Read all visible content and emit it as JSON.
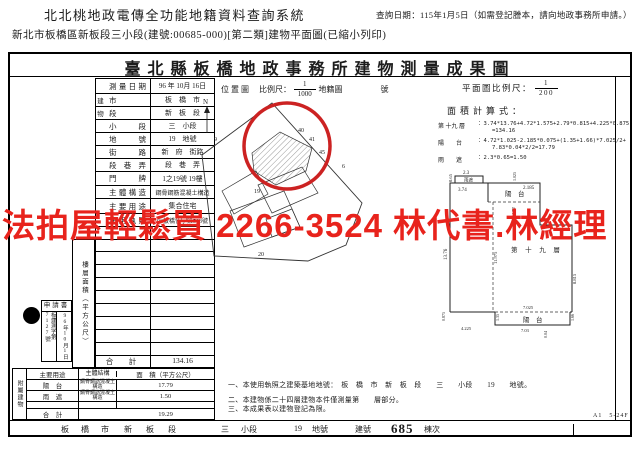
{
  "header": {
    "system_title": "北北桃地政電傳全功能地籍資料查詢系統",
    "query_date": "查詢日期：115年1月5日（如需登記謄本，請向地政事務所申請。）",
    "subtitle": "新北市板橋區新板段三小段(建號:00685-000)[第二類]建物平面圖(已縮小列印)"
  },
  "watermark": {
    "text": "法拍屋輕鬆買  2266-3524  林代書.林經理",
    "color": "#e8231c"
  },
  "doc": {
    "title": "臺北縣板橋地政事務所建物測量成果圖",
    "location_map_label": "位置圖",
    "scale_label": "比例尺：",
    "scale_num": "1",
    "scale_den": "1000",
    "cadastral_label": "地籍圖",
    "cadastral_no_label": "號",
    "plan_scale_label": "平面圖比例尺：",
    "plan_scale_num": "1",
    "plan_scale_den": "200",
    "north": "N",
    "fields": [
      {
        "g": "",
        "label": "測量日期",
        "value": "96 年 10月 16日"
      },
      {
        "g": "建",
        "label": "市",
        "value": "板　橋　市"
      },
      {
        "g": "物",
        "label": "段",
        "value": "新　板　段"
      },
      {
        "g": "",
        "label": "小段",
        "value": "三　小段"
      },
      {
        "g": "",
        "label": "地號",
        "value": "19　地號"
      },
      {
        "g": "",
        "label": "街路",
        "value": "新　府　街路"
      },
      {
        "g": "",
        "label": "段巷弄",
        "value": "段　巷　弄"
      },
      {
        "g": "",
        "label": "門牌",
        "value": "1之19號 19樓"
      },
      {
        "g": "",
        "label": "主體構造",
        "value": "鋼骨鋼筋混凝土構造"
      },
      {
        "g": "",
        "label": "主要用途",
        "value": "集合住宅"
      },
      {
        "g": "",
        "label": "使用執照",
        "value": "96板橋使字第503號"
      },
      {
        "g": "",
        "label": "",
        "value": ""
      }
    ],
    "floor_col_header": "樓層面積（平方公尺）",
    "floor_total_label": "合　計",
    "floor_total_value": "134.16",
    "application": {
      "title": "申請書",
      "doc_no": "板建測字第7127號",
      "date": "96年10月1日"
    },
    "annex": {
      "section_label": "附屬建物",
      "col_usage": "主要用途",
      "col_structure": "主體結構",
      "col_area": "面　積（平方公尺）",
      "rows": [
        {
          "usage": "陽　台",
          "structure": "鋼骨鋼筋混凝土構造",
          "area": "17.79"
        },
        {
          "usage": "雨　遮",
          "structure": "鋼骨鋼筋混凝土構造",
          "area": "1.50"
        }
      ],
      "total_label": "合　計",
      "total_value": "19.29"
    },
    "area_calc": {
      "title": "面積計算式：",
      "lines": [
        {
          "label": "第 十九 層",
          "formula": "：3.74*13.76+4.72*1.575+2.79*0.815+4.225*0.875",
          "formula2": "=134.16"
        },
        {
          "label": "陽　　台",
          "formula": "：4.72*1.025-2.185*0.075+(1.35+1.66)*7.025/2+",
          "formula2": "7.83*0.04*2/2=17.79"
        },
        {
          "label": "雨　　遮",
          "formula": "：2.3*0.65=1.50",
          "formula2": ""
        }
      ]
    },
    "map": {
      "p9": "9",
      "p40": "40",
      "p41": "41",
      "p45": "45",
      "p6": "6",
      "p19": "19",
      "p20": "20",
      "circle_color": "#cc2222"
    },
    "plan": {
      "room_label": "第 十 九 層",
      "balcony_top_label": "陽　台",
      "balcony_bottom_label": "陽　台",
      "canopy_label": "雨遮",
      "dims": {
        "d23": "2.3",
        "d065": "0.65",
        "d374": "3.74",
        "d2185": "2.185",
        "d1025": "1.025",
        "d472": "4.72",
        "d1376": "13.76",
        "d11975": "11.975",
        "d8815": "8.815",
        "d7025": "7.025",
        "d4225": "4.225",
        "d0875": "0.875",
        "d135": "1.35",
        "d703": "7.03",
        "d004": "0.04",
        "d166": "1.66"
      }
    },
    "notes": [
      "一、本使用執照之建築基地地號：　板　橋　市　新　板　段　　三　　小段　　19　　地號。",
      "二、本建物係二十四層建物本件僅測量第　　層部分。",
      "三、本成果表以建物登記為限。"
    ],
    "doc_code": "A1　5-24F",
    "bottom": {
      "items": [
        "板",
        "橋",
        "市",
        "新",
        "板",
        "段",
        "三",
        "小段",
        "19",
        "地號",
        "建號",
        "685",
        "棟次"
      ]
    }
  }
}
